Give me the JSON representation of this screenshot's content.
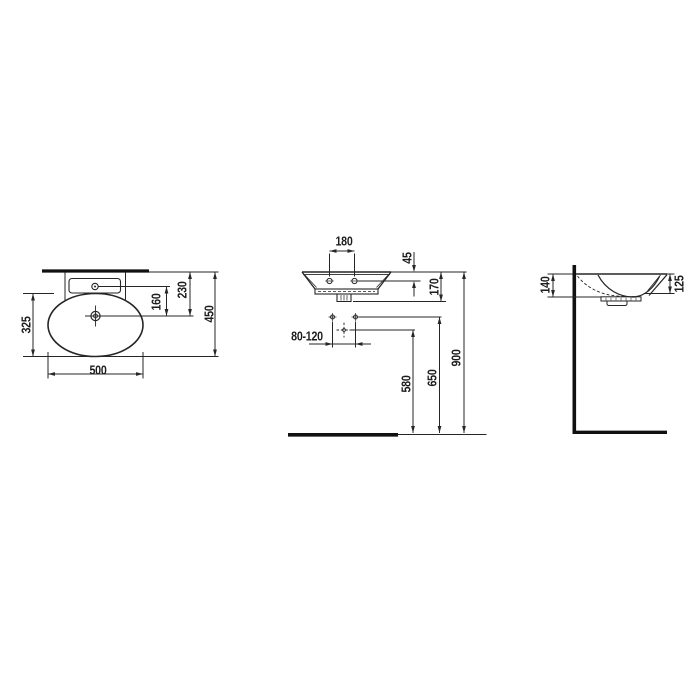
{
  "drawing": {
    "title": "wall-hung washbasin dimension drawing",
    "top_view": {
      "basin_width": "500",
      "basin_depth": "325",
      "overall_depth": "450",
      "faucet_to_drain": "160",
      "wall_to_drain": "230"
    },
    "front_view": {
      "fixing_hole_spacing": "180",
      "rim_to_fixing_holes": "45",
      "rim_to_outlet": "170",
      "supply_offset_range": "80-120",
      "drain_outlet_height": "580",
      "supply_height": "650",
      "rim_height": "900"
    },
    "side_view": {
      "height_at_wall": "140",
      "height_at_front_edge": "125"
    },
    "symbols": {
      "tap_hole": "tap-hole-icon",
      "drain": "drain-icon",
      "fixing_hole": "fixing-hole-icon",
      "water_supply": "water-supply-icon",
      "waste_outlet_center": "waste-outlet-icon"
    },
    "colors": {
      "line": "#262626",
      "heavy_line": "#111111",
      "background": "#ffffff"
    }
  }
}
